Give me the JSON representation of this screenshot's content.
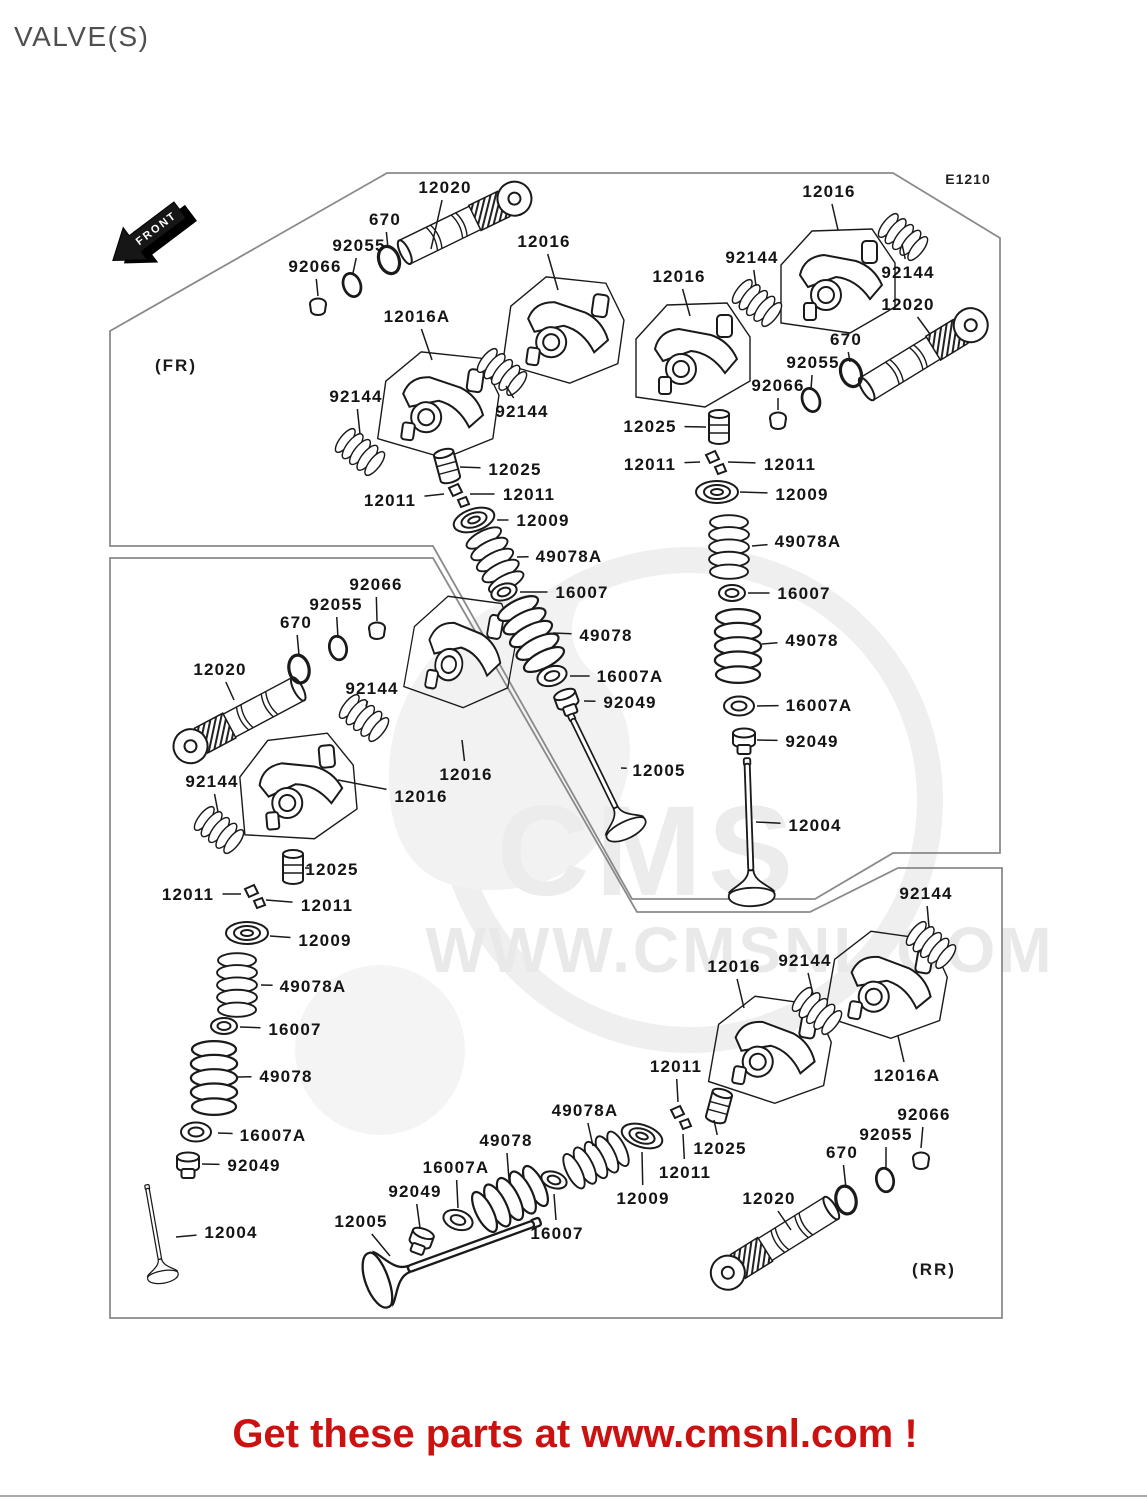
{
  "page": {
    "title": "VALVE(S)",
    "diagram_code": "E1210",
    "front_label": "FRONT",
    "fr_label": "(FR)",
    "rr_label": "(RR)",
    "footer_text": "Get these parts at www.cmsnl.com !",
    "footer_color": "#cc1111",
    "line_color": "#1a1a1a",
    "outline_color": "#8a8a8a"
  },
  "watermark": {
    "logo": "CMS",
    "url": "WWW.CMSNL.COM"
  },
  "part_labels": [
    {
      "t": "12020",
      "x": 445,
      "y": 187,
      "lx": 431,
      "ly": 249
    },
    {
      "t": "670",
      "x": 385,
      "y": 219,
      "lx": 388,
      "ly": 248
    },
    {
      "t": "92055",
      "x": 359,
      "y": 245,
      "lx": 353,
      "ly": 273
    },
    {
      "t": "92066",
      "x": 315,
      "y": 266,
      "lx": 318,
      "ly": 296
    },
    {
      "t": "12016",
      "x": 544,
      "y": 241,
      "lx": 558,
      "ly": 290
    },
    {
      "t": "12016A",
      "x": 417,
      "y": 316,
      "lx": 432,
      "ly": 360
    },
    {
      "t": "92144",
      "x": 356,
      "y": 396,
      "lx": 360,
      "ly": 434
    },
    {
      "t": "92144",
      "x": 522,
      "y": 411,
      "lx": 506,
      "ly": 386
    },
    {
      "t": "12025",
      "x": 515,
      "y": 469,
      "lx": 460,
      "ly": 467
    },
    {
      "t": "12011",
      "x": 390,
      "y": 500,
      "lx": 444,
      "ly": 494
    },
    {
      "t": "12011",
      "x": 529,
      "y": 494,
      "lx": 470,
      "ly": 494
    },
    {
      "t": "12009",
      "x": 543,
      "y": 520,
      "lx": 497,
      "ly": 520
    },
    {
      "t": "49078A",
      "x": 569,
      "y": 556,
      "lx": 517,
      "ly": 557
    },
    {
      "t": "16007",
      "x": 582,
      "y": 592,
      "lx": 520,
      "ly": 592
    },
    {
      "t": "49078",
      "x": 606,
      "y": 635,
      "lx": 553,
      "ly": 633
    },
    {
      "t": "16007A",
      "x": 630,
      "y": 676,
      "lx": 570,
      "ly": 676
    },
    {
      "t": "92049",
      "x": 630,
      "y": 702,
      "lx": 584,
      "ly": 701
    },
    {
      "t": "12005",
      "x": 659,
      "y": 770,
      "lx": 621,
      "ly": 768
    },
    {
      "t": "12016",
      "x": 829,
      "y": 191,
      "lx": 838,
      "ly": 230
    },
    {
      "t": "92144",
      "x": 908,
      "y": 272,
      "lx": 902,
      "ly": 244
    },
    {
      "t": "12016",
      "x": 679,
      "y": 276,
      "lx": 690,
      "ly": 316
    },
    {
      "t": "92144",
      "x": 752,
      "y": 257,
      "lx": 756,
      "ly": 286
    },
    {
      "t": "12020",
      "x": 908,
      "y": 304,
      "lx": 930,
      "ly": 334
    },
    {
      "t": "670",
      "x": 846,
      "y": 339,
      "lx": 850,
      "ly": 362
    },
    {
      "t": "92055",
      "x": 813,
      "y": 362,
      "lx": 811,
      "ly": 389
    },
    {
      "t": "92066",
      "x": 778,
      "y": 385,
      "lx": 778,
      "ly": 410
    },
    {
      "t": "12025",
      "x": 650,
      "y": 426,
      "lx": 706,
      "ly": 427
    },
    {
      "t": "12011",
      "x": 650,
      "y": 464,
      "lx": 700,
      "ly": 462
    },
    {
      "t": "12011",
      "x": 790,
      "y": 464,
      "lx": 728,
      "ly": 462
    },
    {
      "t": "12009",
      "x": 802,
      "y": 494,
      "lx": 740,
      "ly": 492
    },
    {
      "t": "49078A",
      "x": 808,
      "y": 541,
      "lx": 752,
      "ly": 546
    },
    {
      "t": "16007",
      "x": 804,
      "y": 593,
      "lx": 748,
      "ly": 593
    },
    {
      "t": "49078",
      "x": 812,
      "y": 640,
      "lx": 762,
      "ly": 644
    },
    {
      "t": "16007A",
      "x": 819,
      "y": 705,
      "lx": 757,
      "ly": 706
    },
    {
      "t": "92049",
      "x": 812,
      "y": 741,
      "lx": 757,
      "ly": 740
    },
    {
      "t": "12004",
      "x": 815,
      "y": 825,
      "lx": 756,
      "ly": 822
    },
    {
      "t": "12016",
      "x": 466,
      "y": 774,
      "lx": 462,
      "ly": 740
    },
    {
      "t": "12016",
      "x": 421,
      "y": 796,
      "lx": 338,
      "ly": 780
    },
    {
      "t": "92066",
      "x": 376,
      "y": 584,
      "lx": 377,
      "ly": 621
    },
    {
      "t": "92055",
      "x": 336,
      "y": 604,
      "lx": 338,
      "ly": 638
    },
    {
      "t": "670",
      "x": 296,
      "y": 622,
      "lx": 299,
      "ly": 655
    },
    {
      "t": "12020",
      "x": 220,
      "y": 669,
      "lx": 234,
      "ly": 700
    },
    {
      "t": "92144",
      "x": 372,
      "y": 688,
      "lx": 366,
      "ly": 706
    },
    {
      "t": "92144",
      "x": 212,
      "y": 781,
      "lx": 218,
      "ly": 812
    },
    {
      "t": "12025",
      "x": 332,
      "y": 869,
      "lx": 305,
      "ly": 868
    },
    {
      "t": "12011",
      "x": 188,
      "y": 894,
      "lx": 241,
      "ly": 894
    },
    {
      "t": "12011",
      "x": 327,
      "y": 905,
      "lx": 266,
      "ly": 900
    },
    {
      "t": "12009",
      "x": 325,
      "y": 940,
      "lx": 270,
      "ly": 936
    },
    {
      "t": "49078A",
      "x": 313,
      "y": 986,
      "lx": 261,
      "ly": 985
    },
    {
      "t": "16007",
      "x": 295,
      "y": 1029,
      "lx": 240,
      "ly": 1027
    },
    {
      "t": "49078",
      "x": 286,
      "y": 1076,
      "lx": 238,
      "ly": 1077
    },
    {
      "t": "16007A",
      "x": 273,
      "y": 1135,
      "lx": 218,
      "ly": 1133
    },
    {
      "t": "92049",
      "x": 254,
      "y": 1165,
      "lx": 202,
      "ly": 1164
    },
    {
      "t": "12004",
      "x": 231,
      "y": 1232,
      "lx": 176,
      "ly": 1237
    },
    {
      "t": "12005",
      "x": 361,
      "y": 1221,
      "lx": 390,
      "ly": 1256
    },
    {
      "t": "92049",
      "x": 415,
      "y": 1191,
      "lx": 420,
      "ly": 1228
    },
    {
      "t": "16007A",
      "x": 456,
      "y": 1167,
      "lx": 458,
      "ly": 1208
    },
    {
      "t": "49078",
      "x": 506,
      "y": 1140,
      "lx": 509,
      "ly": 1180
    },
    {
      "t": "49078A",
      "x": 585,
      "y": 1110,
      "lx": 593,
      "ly": 1146
    },
    {
      "t": "16007",
      "x": 557,
      "y": 1233,
      "lx": 554,
      "ly": 1194
    },
    {
      "t": "12009",
      "x": 643,
      "y": 1198,
      "lx": 642,
      "ly": 1152
    },
    {
      "t": "12011",
      "x": 676,
      "y": 1066,
      "lx": 678,
      "ly": 1102
    },
    {
      "t": "12011",
      "x": 685,
      "y": 1172,
      "lx": 683,
      "ly": 1134
    },
    {
      "t": "12025",
      "x": 720,
      "y": 1148,
      "lx": 714,
      "ly": 1120
    },
    {
      "t": "12020",
      "x": 769,
      "y": 1198,
      "lx": 791,
      "ly": 1230
    },
    {
      "t": "92144",
      "x": 926,
      "y": 893,
      "lx": 929,
      "ly": 927
    },
    {
      "t": "92144",
      "x": 805,
      "y": 960,
      "lx": 813,
      "ly": 994
    },
    {
      "t": "12016",
      "x": 734,
      "y": 966,
      "lx": 744,
      "ly": 1008
    },
    {
      "t": "12016A",
      "x": 907,
      "y": 1075,
      "lx": 898,
      "ly": 1036
    },
    {
      "t": "92066",
      "x": 924,
      "y": 1114,
      "lx": 921,
      "ly": 1148
    },
    {
      "t": "92055",
      "x": 886,
      "y": 1134,
      "lx": 886,
      "ly": 1168
    },
    {
      "t": "670",
      "x": 842,
      "y": 1152,
      "lx": 846,
      "ly": 1188
    }
  ]
}
